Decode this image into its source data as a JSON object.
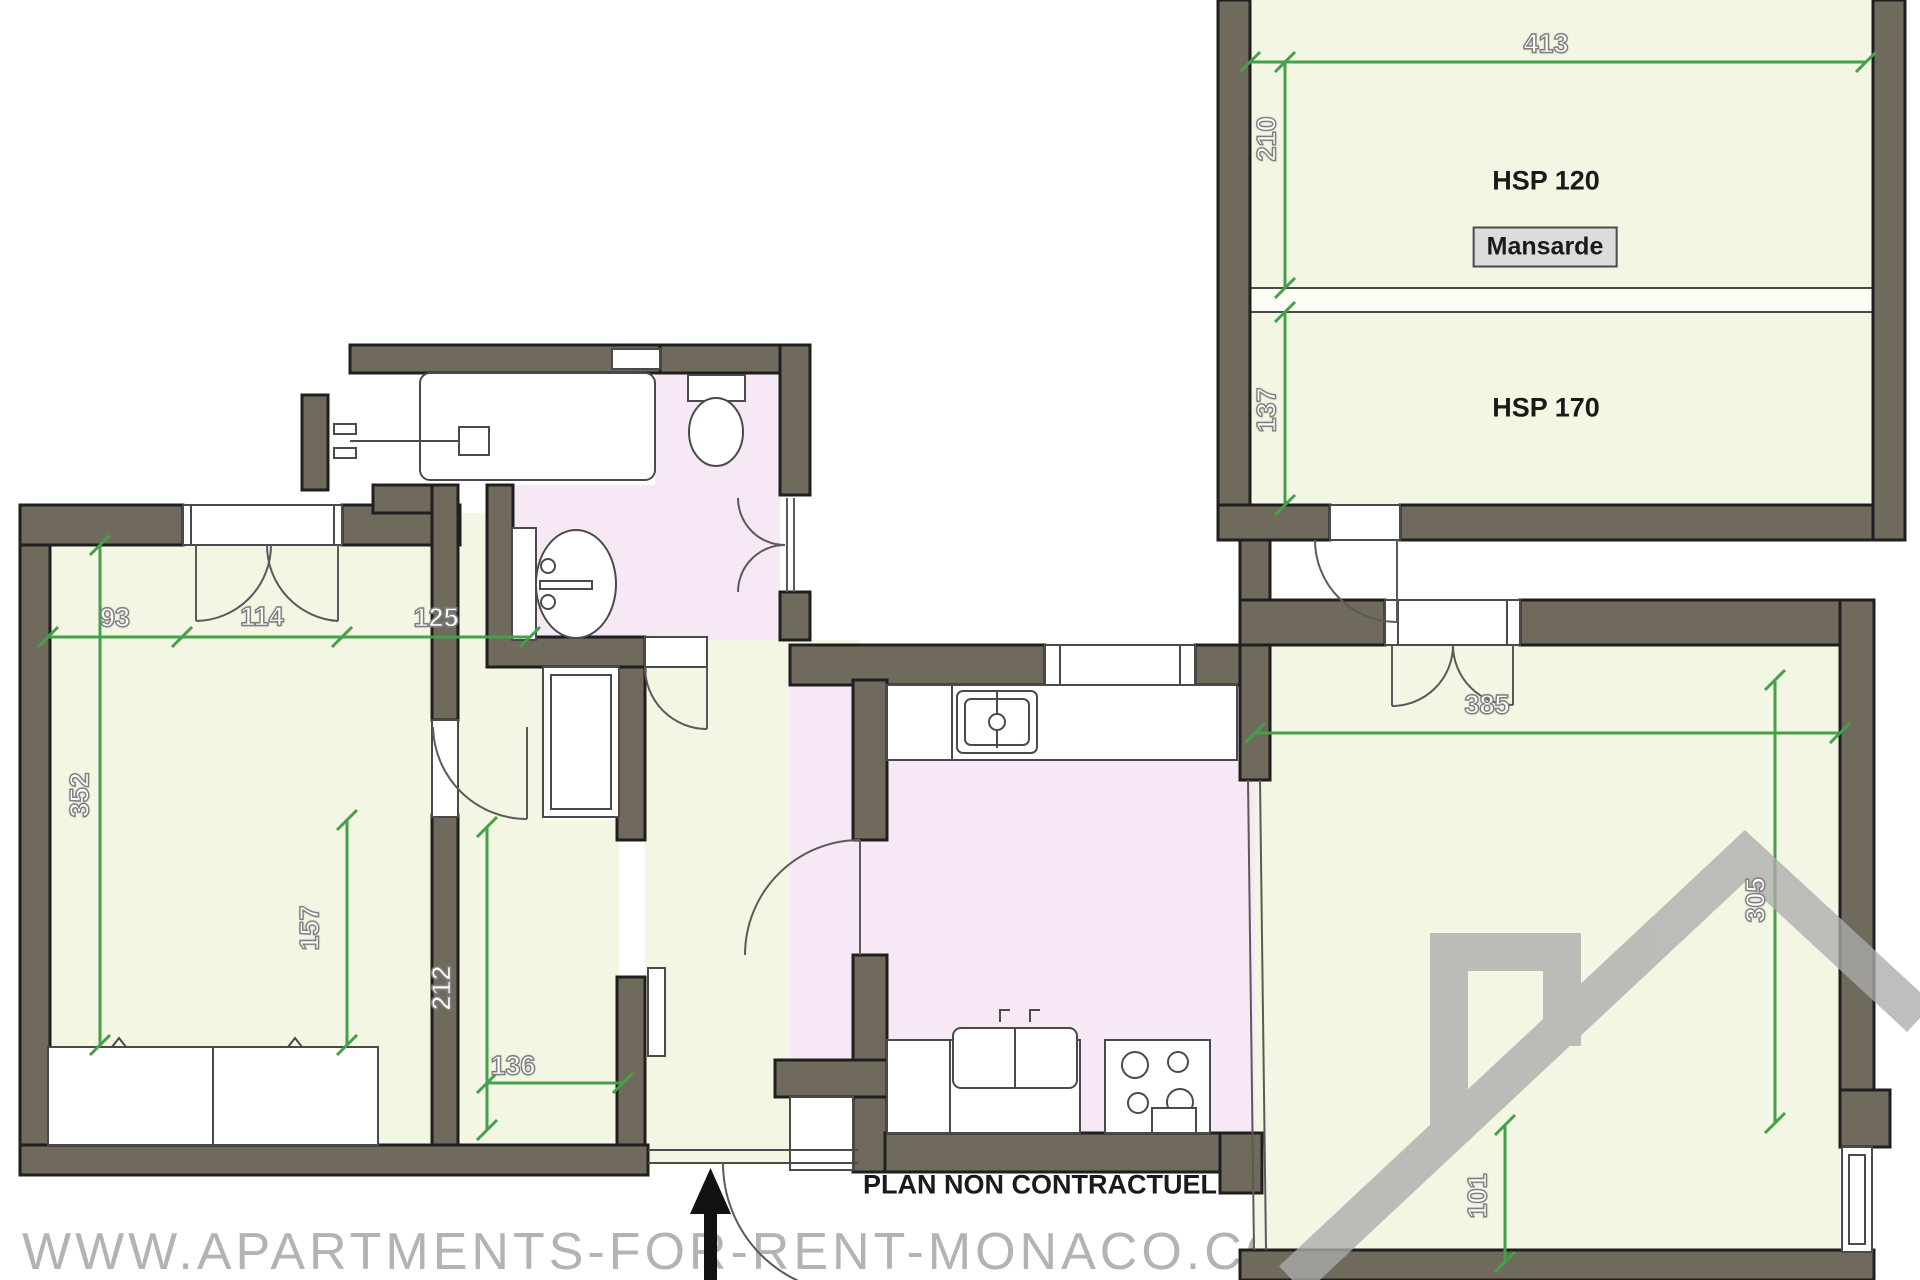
{
  "colors": {
    "wall": "#6f6a5b",
    "wall-outline": "#1f1f1f",
    "room-green": "#f3f6e2",
    "room-pink": "#f7e8f6",
    "dim-green": "#44a04b",
    "line": "#4a4a4a",
    "label": "#1a1a1a",
    "watermark": "#b3b3b3",
    "logo": "#acacac",
    "mansarde-box-bg": "#dcdcdc"
  },
  "mansarde": {
    "dim_width": "413",
    "dim_upper_height": "210",
    "dim_lower_height": "137",
    "hsp_upper": "HSP 120",
    "room_label": "Mansarde",
    "hsp_lower": "HSP 170"
  },
  "main_floor": {
    "dims": {
      "d93": "93",
      "d114": "114",
      "d125": "125",
      "d352": "352",
      "d157": "157",
      "d212": "212",
      "d136": "136",
      "d385": "385",
      "d305": "305",
      "d101": "101"
    }
  },
  "footer": {
    "disclaimer": "PLAN NON CONTRACTUEL",
    "watermark": "WWW.APARTMENTS-FOR-RENT-MONACO.COM"
  }
}
